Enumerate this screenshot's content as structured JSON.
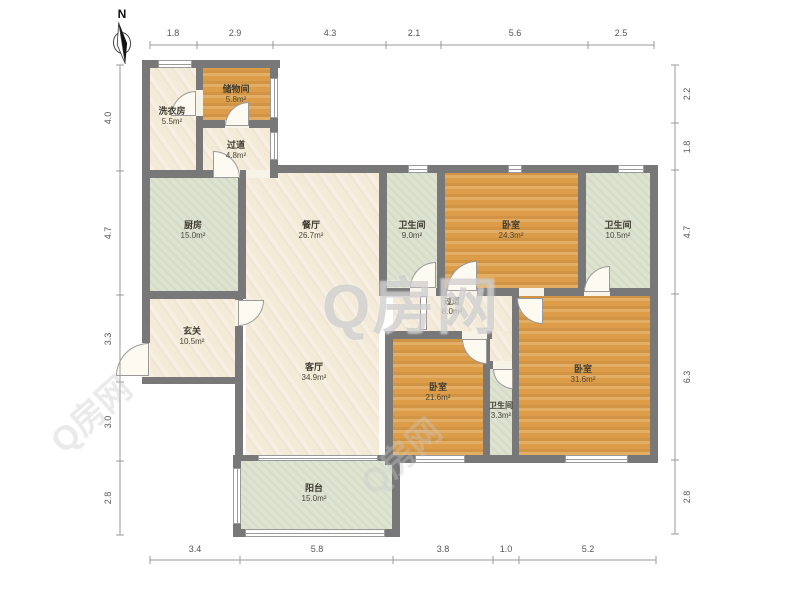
{
  "meta": {
    "compass_label": "N"
  },
  "watermark": {
    "center": "Q房网",
    "diagonal": "Q房网"
  },
  "colors": {
    "wall": "#787878",
    "room_cream": "#f3ead8",
    "room_orange": "#dd9d48",
    "room_green": "#dde3cf",
    "balcony_green": "#dfe4d1",
    "dimension_text": "#555555",
    "label_text": "#3f3b30",
    "watermark_gray": "#c8c8c8"
  },
  "dimensions": {
    "top": [
      "1.8",
      "2.9",
      "4.3",
      "2.1",
      "5.6",
      "2.5"
    ],
    "bottom": [
      "3.4",
      "5.8",
      "3.8",
      "1.0",
      "5.2"
    ],
    "left": [
      "4.0",
      "4.7",
      "3.3",
      "3.0",
      "2.8"
    ],
    "right": [
      "2.2",
      "1.8",
      "4.7",
      "6.3",
      "2.8"
    ]
  },
  "rooms": [
    {
      "name": "洗衣房",
      "area": "5.5m²"
    },
    {
      "name": "储物间",
      "area": "5.8m²"
    },
    {
      "name": "过道",
      "area": "4.8m²"
    },
    {
      "name": "厨房",
      "area": "15.0m²"
    },
    {
      "name": "餐厅",
      "area": "26.7m²"
    },
    {
      "name": "玄关",
      "area": "10.5m²"
    },
    {
      "name": "客厅",
      "area": "34.9m²"
    },
    {
      "name": "卫生间",
      "area": "9.0m²"
    },
    {
      "name": "卧室",
      "area": "24.3m²"
    },
    {
      "name": "卫生间",
      "area": "10.5m²"
    },
    {
      "name": "过道",
      "area": "8.0m²"
    },
    {
      "name": "卧室",
      "area": "21.6m²"
    },
    {
      "name": "卫生间",
      "area": "3.3m²"
    },
    {
      "name": "卧室",
      "area": "31.6m²"
    },
    {
      "name": "阳台",
      "area": "15.0m²"
    }
  ]
}
